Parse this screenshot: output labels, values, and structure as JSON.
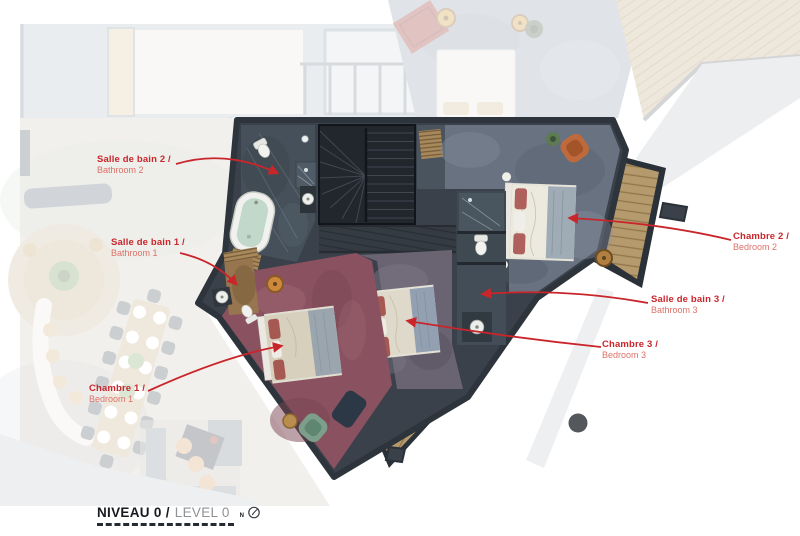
{
  "canvas": {
    "width": 800,
    "height": 536
  },
  "callouts": {
    "bathroom2": {
      "fr": "Salle de bain 2 /",
      "en": "Bathroom 2"
    },
    "bathroom1": {
      "fr": "Salle de bain 1 /",
      "en": "Bathroom 1"
    },
    "bedroom1": {
      "fr": "Chambre 1 /",
      "en": "Bedroom 1"
    },
    "bedroom2": {
      "fr": "Chambre 2 /",
      "en": "Bedroom 2"
    },
    "bathroom3": {
      "fr": "Salle de bain 3 /",
      "en": "Bathroom 3"
    },
    "bedroom3": {
      "fr": "Chambre 3 /",
      "en": "Bedroom 3"
    }
  },
  "title": {
    "level_fr": "NIVEAU 0 /",
    "level_en": "LEVEL 0",
    "compass_letter": "N"
  },
  "colors": {
    "callout_primary": "#c9262c",
    "callout_secondary": "#dd7168",
    "walls": "#3a414a",
    "carpet_bedroom1": "#8a5260",
    "carpet_bedroom2": "#687281",
    "carpet_bedroom3": "#6a6472",
    "slate_floor": "#45505a",
    "deck_wood": "#b59a6d",
    "title_dark": "#171b20",
    "title_muted": "#8f9296"
  }
}
